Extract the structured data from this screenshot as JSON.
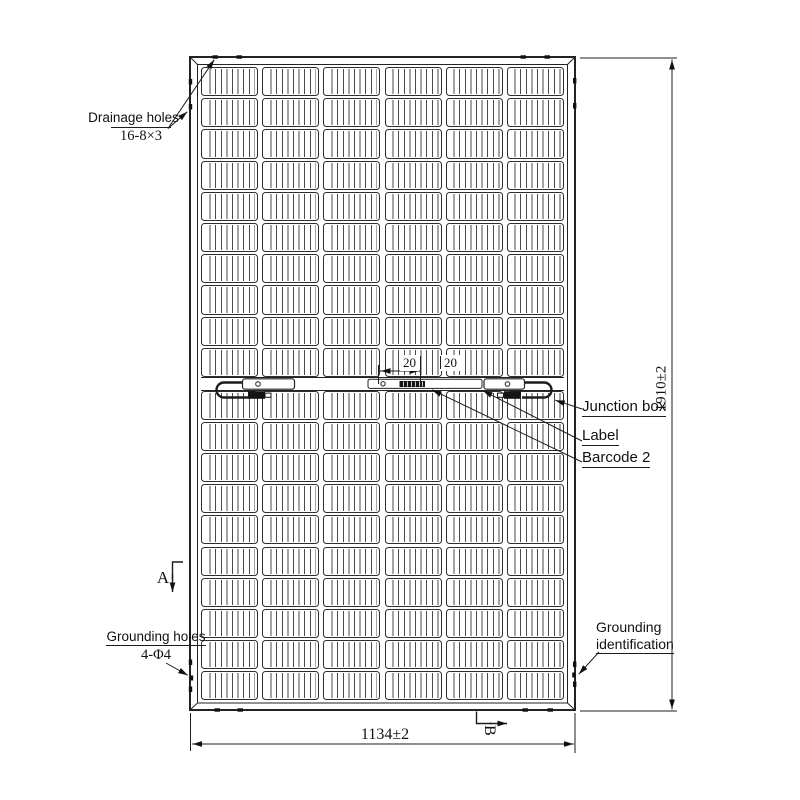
{
  "annotations": {
    "drainage_holes": {
      "label": "Drainage holes",
      "spec": "16-8×3"
    },
    "junction_box": {
      "label": "Junction box"
    },
    "module_label": {
      "label": "Label"
    },
    "barcode": {
      "label": "Barcode 2"
    },
    "grounding_holes": {
      "label": "Grounding holes",
      "spec": "4-Φ4"
    },
    "grounding_identification": {
      "line1": "Grounding",
      "line2": "identification"
    },
    "section_a": "A",
    "section_b": "B"
  },
  "dimensions": {
    "overall_width": "1134±2",
    "overall_height": "1910±2",
    "label_dim_left": "20",
    "label_dim_right": "20"
  },
  "panel": {
    "columns": 6,
    "rows_per_half": 10,
    "halves": 2
  },
  "colors": {
    "line": "#222222",
    "background": "#ffffff"
  }
}
